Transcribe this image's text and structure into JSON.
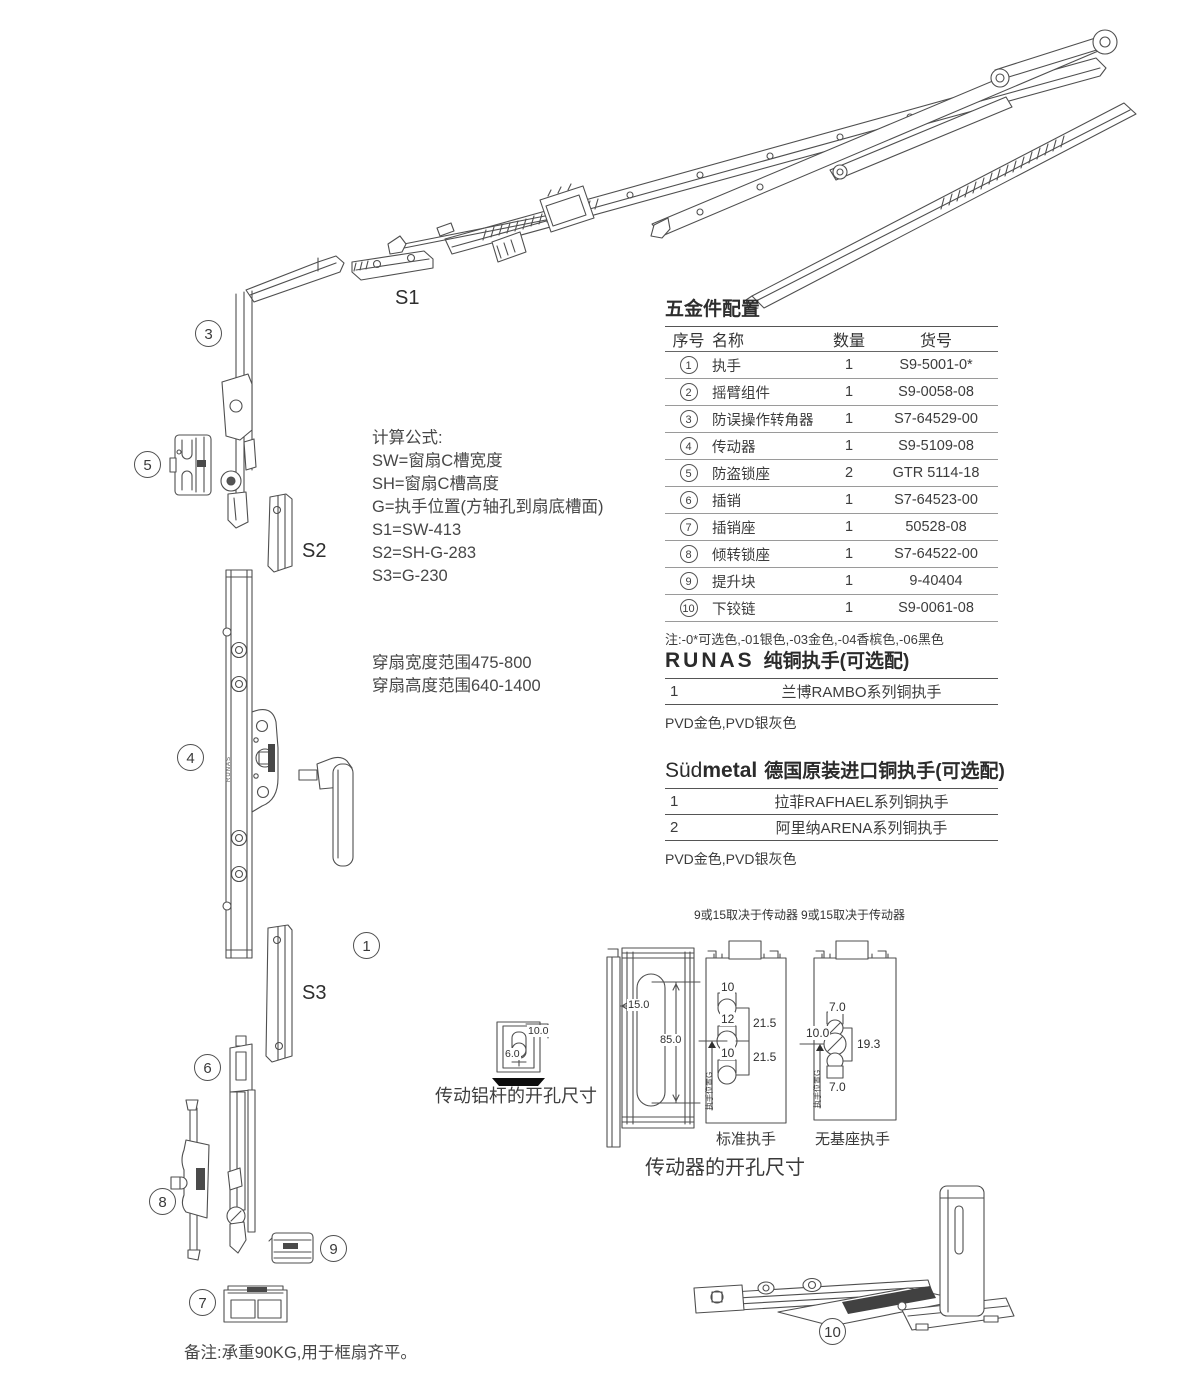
{
  "diagram": {
    "s_labels": {
      "s1": "S1",
      "s2": "S2",
      "s3": "S3"
    },
    "parts": {
      "n1": "1",
      "n3": "3",
      "n4": "4",
      "n5": "5",
      "n6": "6",
      "n7": "7",
      "n8": "8",
      "n9": "9",
      "n10": "10"
    },
    "rod_brand": "RUNAS"
  },
  "formulas": {
    "title": "计算公式:",
    "lines": [
      "SW=窗扇C槽宽度",
      "SH=窗扇C槽高度",
      "G=执手位置(方轴孔到扇底槽面)",
      "S1=SW-413",
      "S2=SH-G-283",
      "S3=G-230"
    ]
  },
  "sash_range": {
    "line1": "穿扇宽度范围475-800",
    "line2": "穿扇高度范围640-1400"
  },
  "hardware_table": {
    "title": "五金件配置",
    "headers": [
      "序号",
      "名称",
      "数量",
      "货号"
    ],
    "rows": [
      {
        "no": "1",
        "name": "执手",
        "qty": "1",
        "code": "S9-5001-0*"
      },
      {
        "no": "2",
        "name": "摇臂组件",
        "qty": "1",
        "code": "S9-0058-08"
      },
      {
        "no": "3",
        "name": "防误操作转角器",
        "qty": "1",
        "code": "S7-64529-00"
      },
      {
        "no": "4",
        "name": "传动器",
        "qty": "1",
        "code": "S9-5109-08"
      },
      {
        "no": "5",
        "name": "防盗锁座",
        "qty": "2",
        "code": "GTR 5114-18"
      },
      {
        "no": "6",
        "name": "插销",
        "qty": "1",
        "code": "S7-64523-00"
      },
      {
        "no": "7",
        "name": "插销座",
        "qty": "1",
        "code": "50528-08"
      },
      {
        "no": "8",
        "name": "倾转锁座",
        "qty": "1",
        "code": "S7-64522-00"
      },
      {
        "no": "9",
        "name": "提升块",
        "qty": "1",
        "code": "9-40404"
      },
      {
        "no": "10",
        "name": "下铰链",
        "qty": "1",
        "code": "S9-0061-08"
      }
    ],
    "note": "注:-0*可选色,-01银色,-03金色,-04香槟色,-06黑色"
  },
  "runas_section": {
    "brand": "RUNAS",
    "title": "纯铜执手(可选配)",
    "rows": [
      {
        "no": "1",
        "name": "兰博RAMBO系列铜执手"
      }
    ],
    "note": "PVD金色,PVD银灰色"
  },
  "sudmetal_section": {
    "brand_light": "Süd",
    "brand_bold": "metal",
    "title": "德国原装进口铜执手(可选配)",
    "rows": [
      {
        "no": "1",
        "name": "拉菲RAFHAEL系列铜执手"
      },
      {
        "no": "2",
        "name": "阿里纳ARENA系列铜执手"
      }
    ],
    "note": "PVD金色,PVD银灰色"
  },
  "drill_rod": {
    "caption": "传动铝杆的开孔尺寸",
    "dim_top": "10.0",
    "dim_left": "6.0"
  },
  "drill_gear": {
    "caption": "传动器的开孔尺寸",
    "profile": {
      "slot_width": "15.0",
      "slot_height": "85.0"
    },
    "standard": {
      "top_note": "9或15取决于传动器",
      "caption": "标准执手",
      "hole_top": "10",
      "hole_mid": "12",
      "hole_bot": "10",
      "span_top": "21.5",
      "span_bot": "21.5",
      "axis_label": "执手位置G"
    },
    "no_base": {
      "top_note": "9或15取决于传动器",
      "caption": "无基座执手",
      "dim_top": "7.0",
      "dim_left": "10.0",
      "dim_right": "19.3",
      "dim_bot": "7.0",
      "axis_label": "执手位置G"
    }
  },
  "footer_note": "备注:承重90KG,用于框扇齐平。"
}
